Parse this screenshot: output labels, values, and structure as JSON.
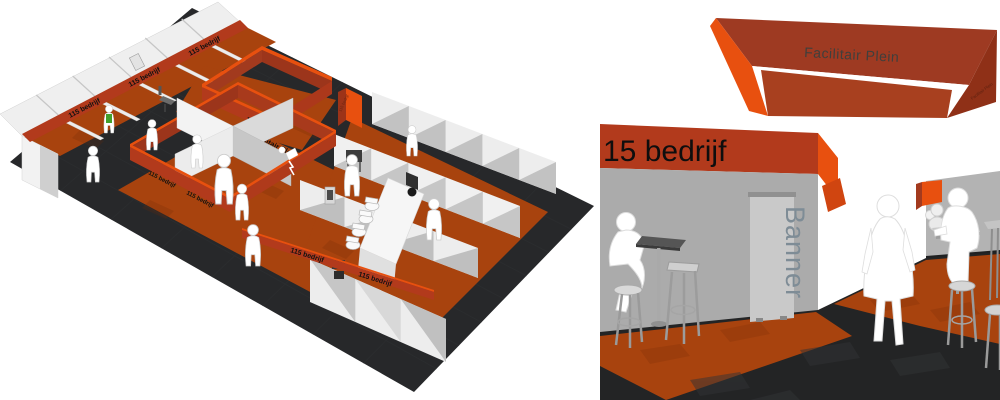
{
  "colors": {
    "accent_orange": "#E8500F",
    "fascia_red": "#B23A1C",
    "fascia_dark": "#9E3A22",
    "carpet_orange": "#A8430E",
    "floor_dark": "#27282A",
    "wall_light": "#EDEDED",
    "wall_mid": "#ABABAB",
    "banner_text": "#7E8C96"
  },
  "overview": {
    "label_booth": "115 bedrijf",
    "label_plein": "Facilitair Plein"
  },
  "closeup": {
    "label_fascia": "15 bedrijf",
    "label_ring": "Facilitair Plein",
    "label_ring_side": "Facilitair Plein",
    "label_banner": "Banner"
  }
}
